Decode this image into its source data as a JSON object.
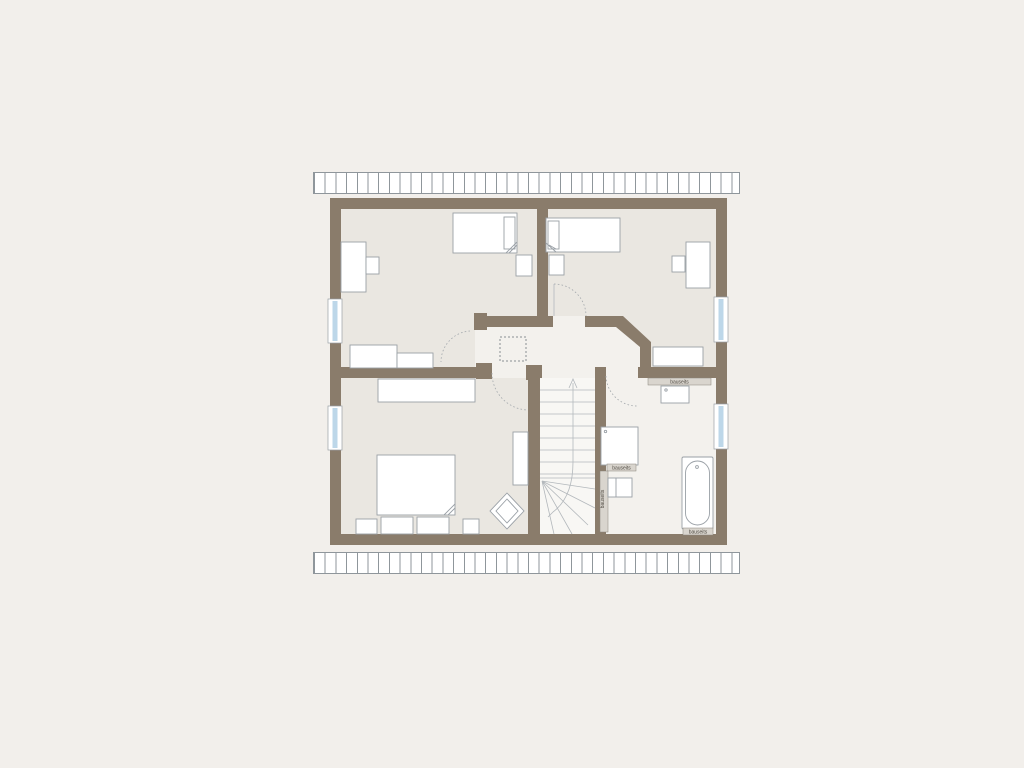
{
  "labels": {
    "vanity": "bauseits",
    "shower": "bauseits",
    "column": "bauseits",
    "bathtub": "bauseits"
  },
  "colors": {
    "page-bg": "#f2efeb",
    "wall": "#8a7c6b",
    "room-floor": "#eae7e1",
    "hall-floor": "#f3f1ed",
    "stair-floor": "#f8f7f4",
    "furniture-stroke": "#9aa0a6",
    "furniture-fill": "#ffffff",
    "window-glass": "#bdd7e9",
    "band-stroke": "#8f969b",
    "label-strip": "#d9d5ce",
    "label-text": "#4f4a42",
    "dash": "#a3a8ac"
  }
}
